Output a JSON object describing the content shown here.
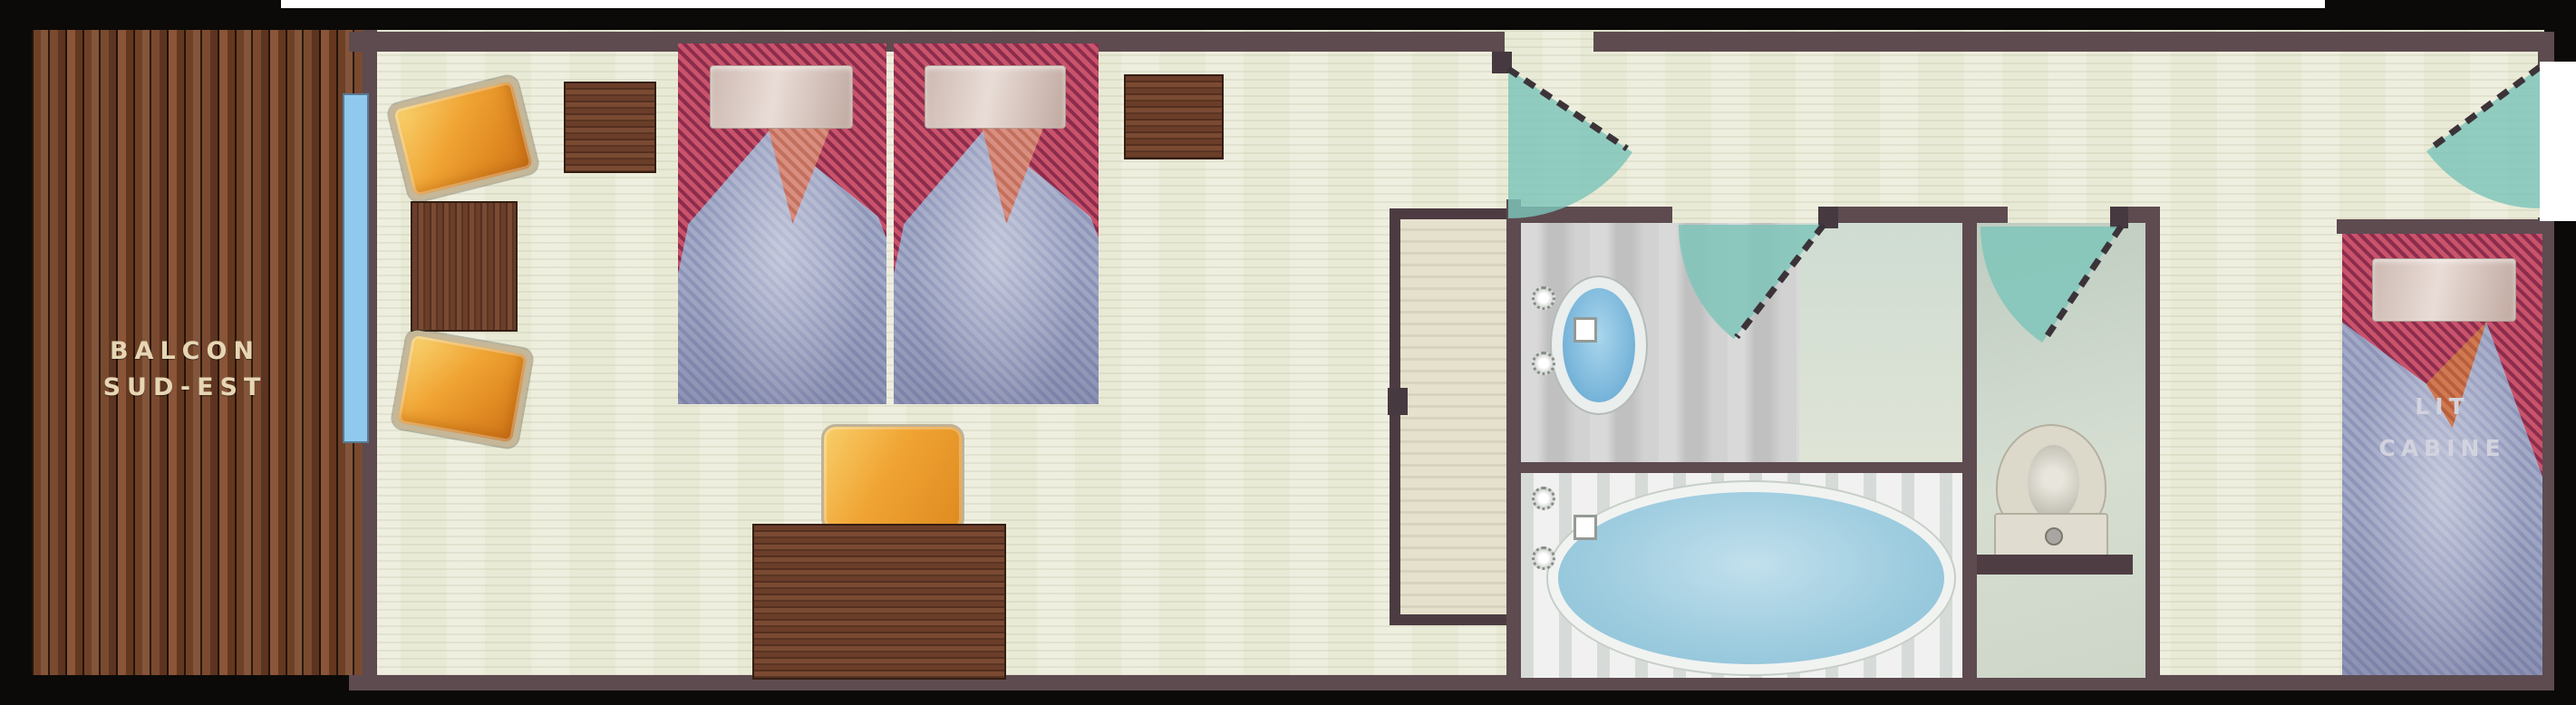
{
  "plan": {
    "balcony": {
      "line1": "BALCON",
      "line2": "SUD-EST"
    },
    "cabin_bed": {
      "line1": "LIT",
      "line2": "CABINE"
    }
  },
  "colors": {
    "frame": "#0b0a08",
    "wall": "#5d4b50",
    "floor": "#e9ead6",
    "window_glass": "#8fc9ee",
    "door_swing": "#7cc4ba",
    "bedspread_red": "#c9536b",
    "bedspread_red_dark": "#8c2c4d",
    "duvet_blue": "#a3aac6",
    "duvet_blue_dark": "#8d95b8",
    "armchair_orange": "#f0a433",
    "wood": "#6b3e2a",
    "bathtub_blue": "#9fcde0",
    "sink_blue": "#7db8dc",
    "wc_floor": "#c9d4c6",
    "toilet": "#dcd8ca",
    "balcony_label": "#e6d6b4",
    "cabin_label": "#d2d3de"
  }
}
